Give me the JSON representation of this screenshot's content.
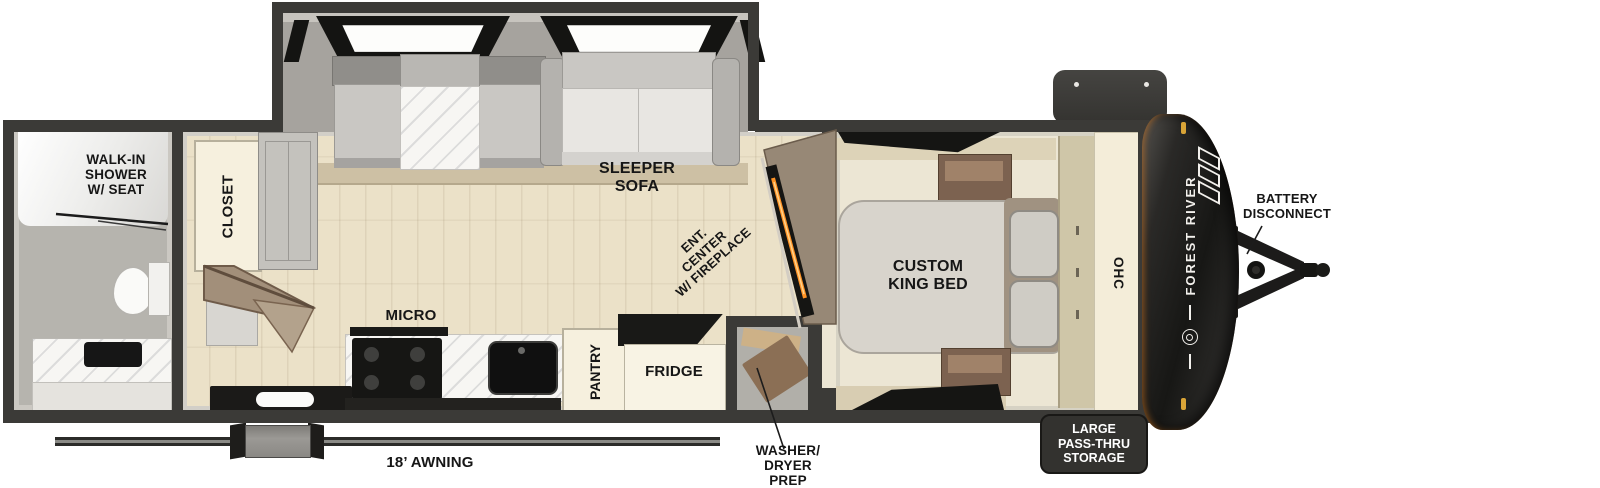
{
  "labels": {
    "walk_in_shower": "WALK-IN\nSHOWER\nW/ SEAT",
    "closet": "CLOSET",
    "sleeper_sofa": "SLEEPER\nSOFA",
    "ent_center": "ENT.\nCENTER\nW/ FIREPLACE",
    "micro": "MICRO",
    "pantry": "PANTRY",
    "fridge": "FRIDGE",
    "custom_king_bed": "CUSTOM\nKING BED",
    "ohc": "OHC",
    "battery_disconnect": "BATTERY\nDISCONNECT",
    "pass_thru_storage": "LARGE\nPASS-THRU\nSTORAGE",
    "washer_dryer_prep": "WASHER/\nDRYER\nPREP",
    "awning": "18’ AWNING",
    "brand": "FOREST RIVER"
  },
  "colors": {
    "wall": "#3b3a37",
    "floor_wood": "#ebe1c8",
    "floor_bed": "#ece6d4",
    "floor_bath": "#b6b4ae",
    "slide_interior": "#a6a39e",
    "cabinet_cream": "#f6f0de",
    "appliance_black": "#161614",
    "fireplace_glow": "#ff9326",
    "amber_light": "#d9a437",
    "cap_dark": "#171715",
    "badge_bg": "#33322f",
    "badge_text": "#ffffff",
    "label_text": "#161616",
    "brand_text": "#f2f0ec"
  }
}
